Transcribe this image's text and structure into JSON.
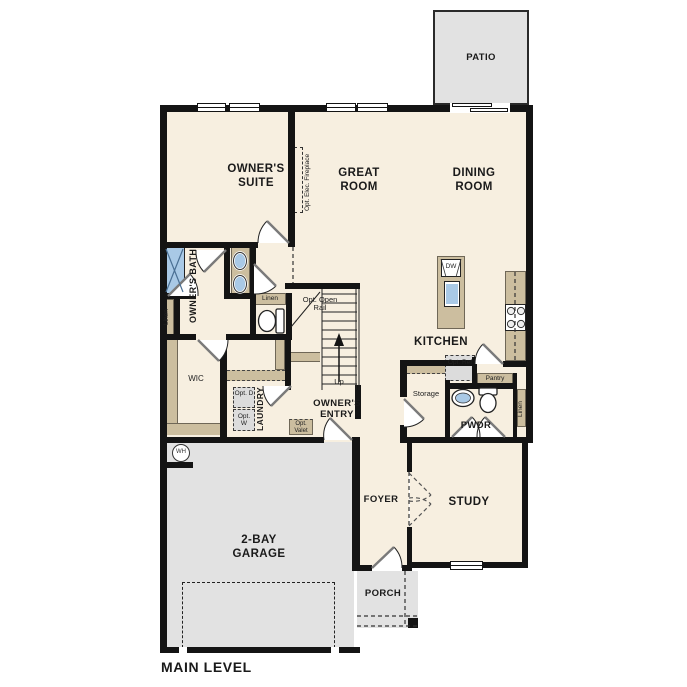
{
  "title": "MAIN LEVEL",
  "colors": {
    "floor": "#f7efe0",
    "wall": "#141414",
    "outdoor_gray": "#e2e2e2",
    "cabinet_tan": "#ccbe9f",
    "fixture_blue": "#a9c9e6",
    "appliance_gray": "#dcdcdc"
  },
  "rooms": {
    "patio": "PATIO",
    "owners_suite": "OWNER'S SUITE",
    "great_room": "GREAT ROOM",
    "dining_room": "DINING ROOM",
    "owners_bath": "OWNER'S BATH",
    "kitchen": "KITCHEN",
    "wic": "WIC",
    "laundry": "LAUNDRY",
    "owners_entry": "OWNER'S ENTRY",
    "pwdr": "PWDR",
    "garage": "2-BAY GARAGE",
    "foyer": "FOYER",
    "study": "STUDY",
    "porch": "PORCH"
  },
  "annotations": {
    "fireplace": "Opt. Elec. Fireplace",
    "open_rail": "Opt. Open Rail",
    "up": "Up",
    "linen_bath": "Linen",
    "linen_closet": "Linen",
    "linen_pwdr": "Linen",
    "pantry": "Pantry",
    "storage": "Storage",
    "opt_ref": "Opt. Ref",
    "opt_dryer": "Opt. D",
    "opt_washer": "Opt. W",
    "opt_valet": "Opt. Valet",
    "dishwasher": "DW",
    "water_heater": "WH"
  }
}
